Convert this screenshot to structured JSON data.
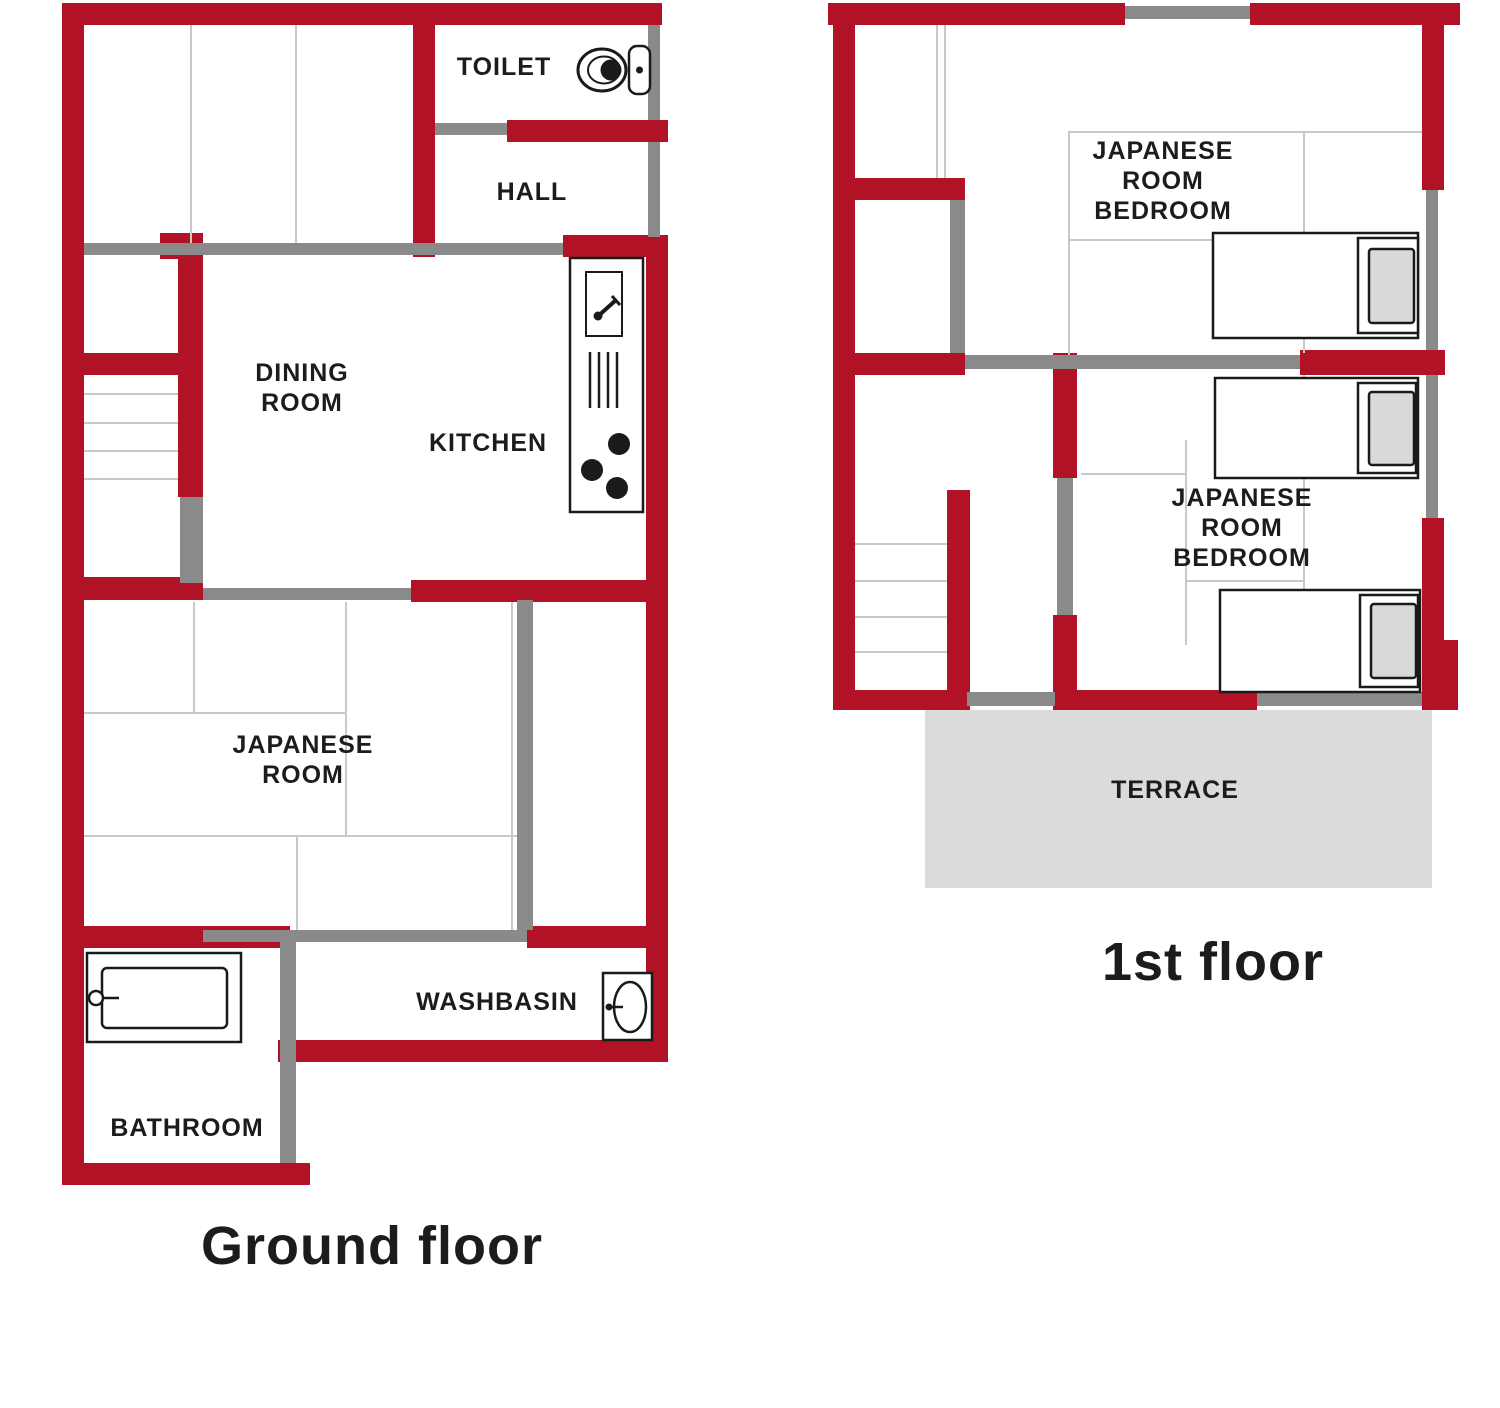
{
  "palette": {
    "wall_red": "#b11226",
    "wall_gray": "#8a8a8a",
    "tatami_line": "#c9c9c9",
    "terrace_fill": "#dbdbdb",
    "ink": "#1c1c1c"
  },
  "ground_floor": {
    "caption": "Ground floor",
    "labels": {
      "toilet": "TOILET",
      "hall": "HALL",
      "dining_room": "DINING\nROOM",
      "kitchen": "KITCHEN",
      "japanese_room": "JAPANESE\nROOM",
      "washbasin": "WASHBASIN",
      "bathroom": "BATHROOM"
    },
    "icons": [
      "toilet-icon",
      "kitchen-counter-icon",
      "stairs",
      "bathtub-icon",
      "washbasin-icon"
    ]
  },
  "first_floor": {
    "caption": "1st floor",
    "labels": {
      "bedroom_top": "JAPANESE\nROOM\nBEDROOM",
      "bedroom_bottom": "JAPANESE\nROOM\nBEDROOM",
      "terrace": "TERRACE"
    },
    "icons": [
      "bed-icon",
      "bed-icon",
      "bed-icon",
      "stairs"
    ]
  }
}
